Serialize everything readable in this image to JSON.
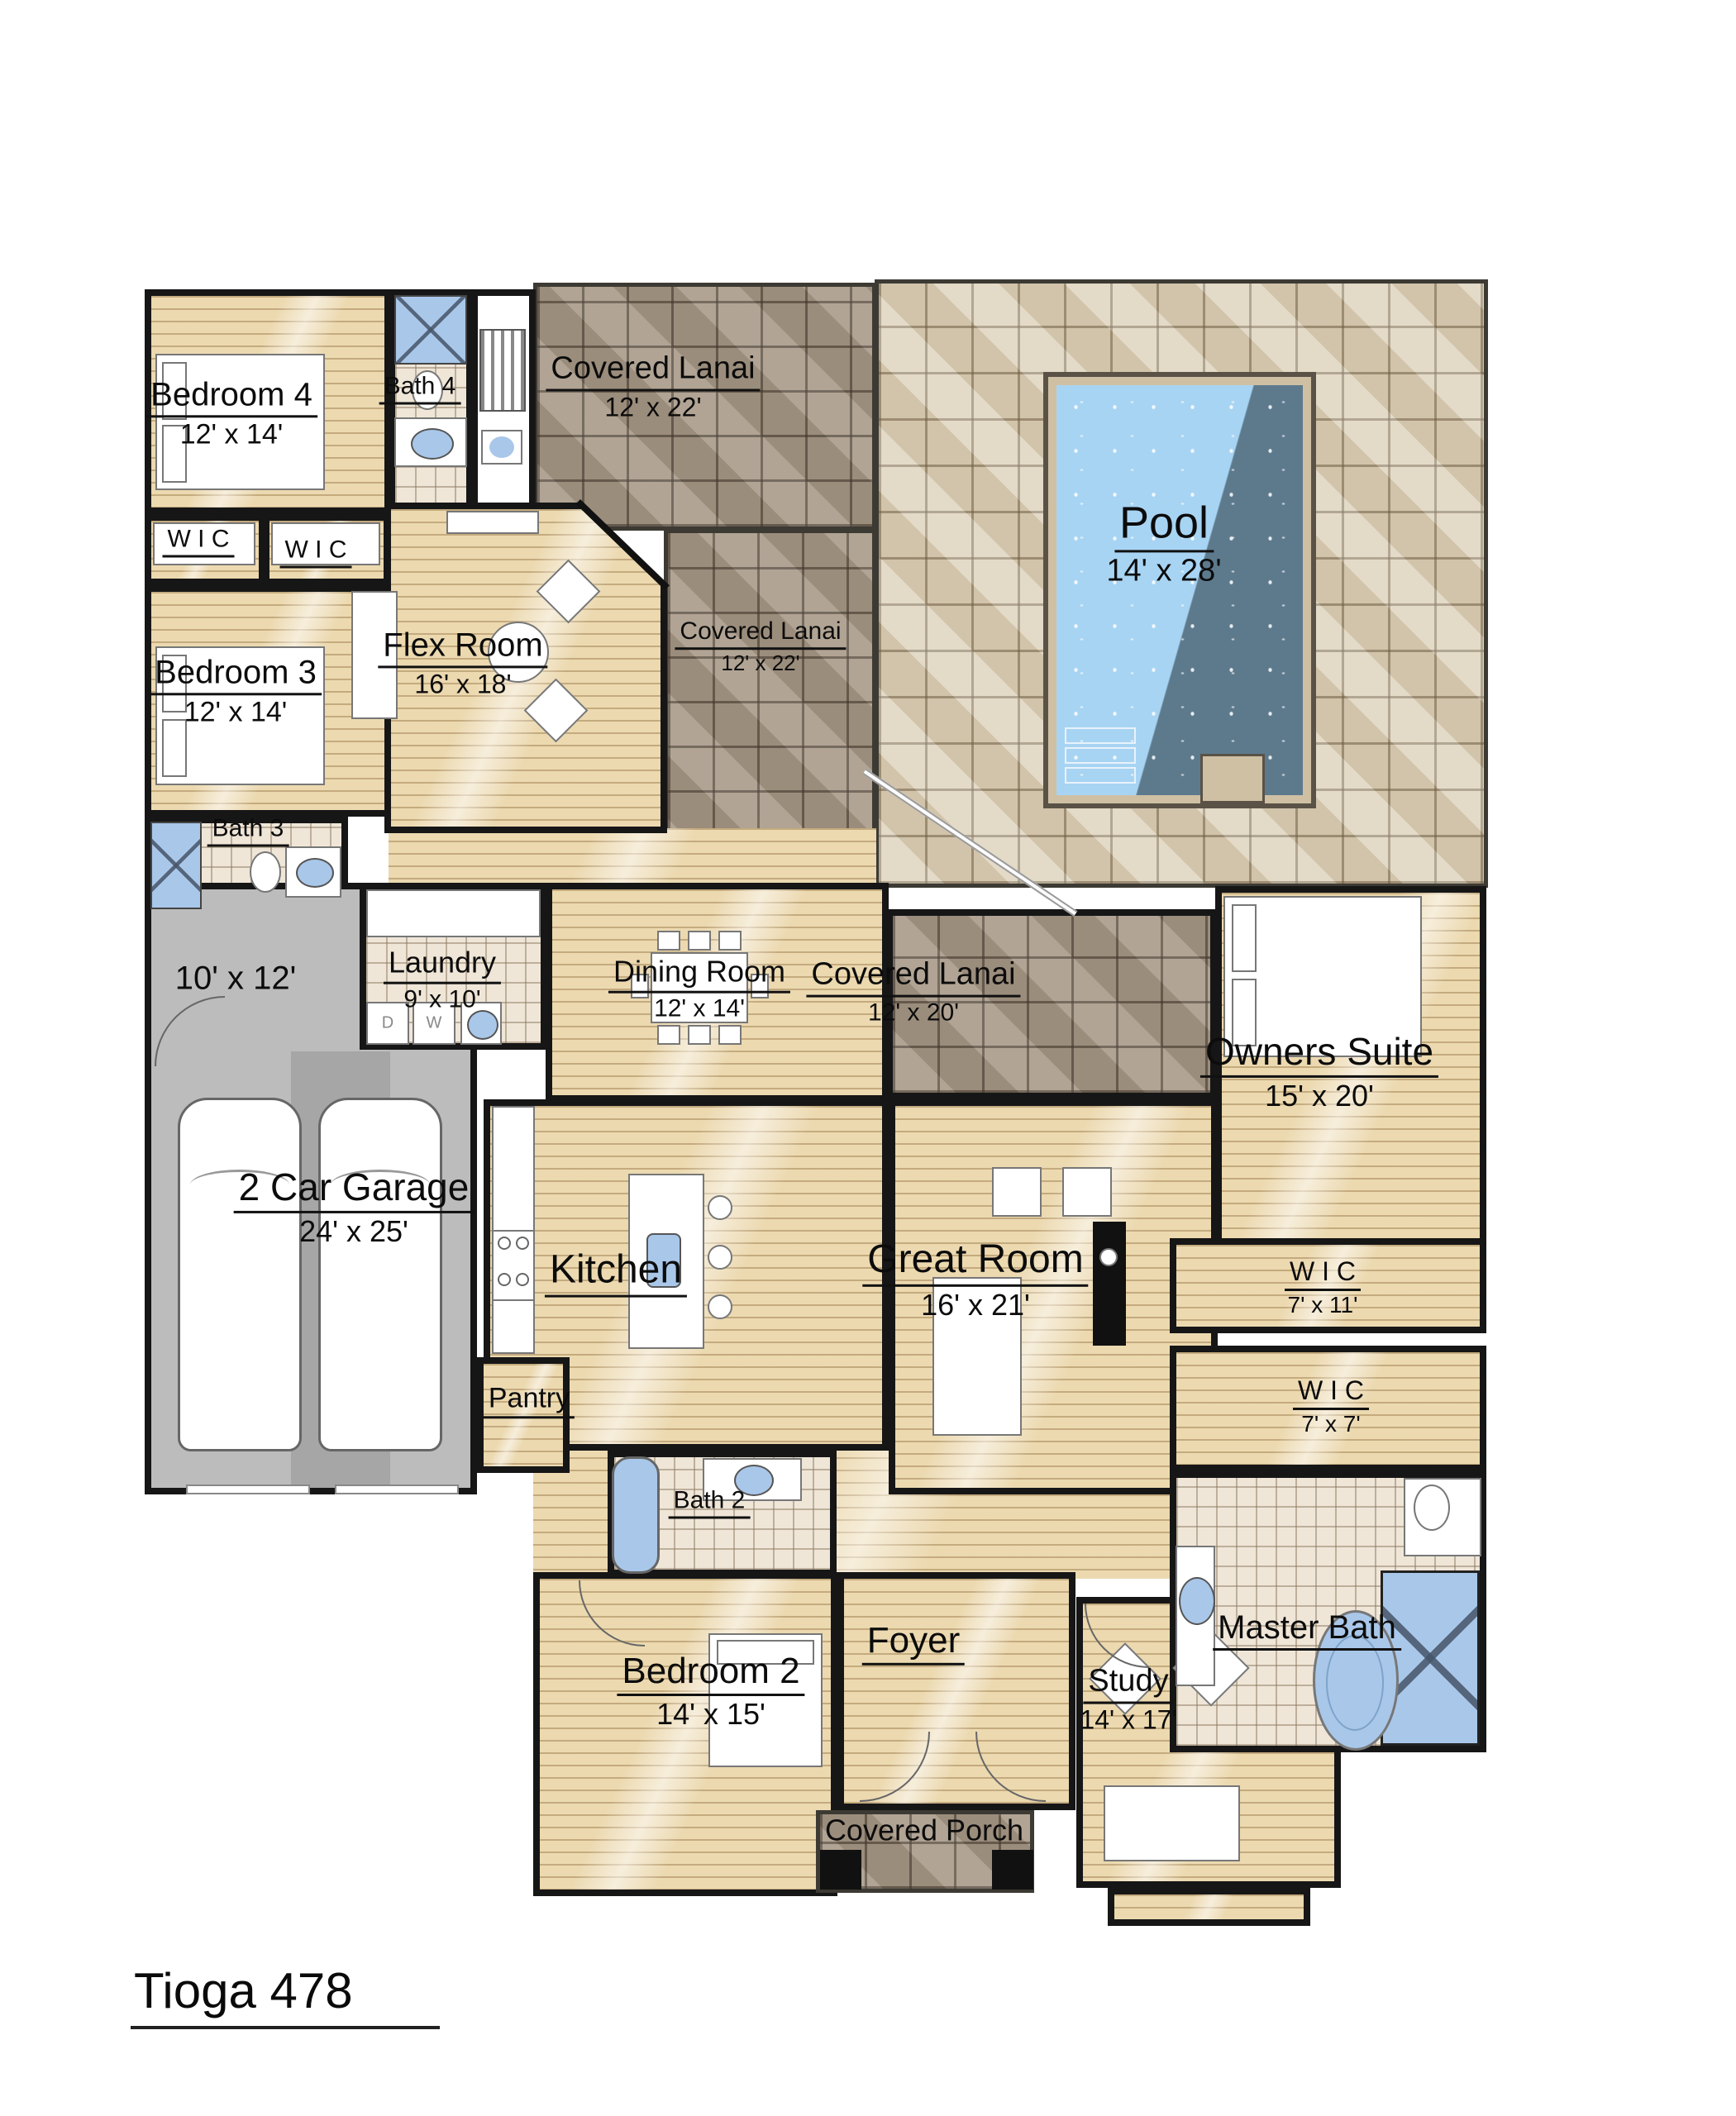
{
  "title": "Tioga 478",
  "rooms": {
    "bedroom4": {
      "name": "Bedroom 4",
      "dims": "12' x 14'"
    },
    "bath4": {
      "name": "Bath 4"
    },
    "lanai_top": {
      "name": "Covered Lanai",
      "dims": "12' x 22'"
    },
    "lanai_mid": {
      "name": "Covered Lanai",
      "dims": "12' x 22'"
    },
    "lanai_right": {
      "name": "Covered Lanai",
      "dims": "12' x 20'"
    },
    "pool": {
      "name": "Pool",
      "dims": "14' x 28'"
    },
    "wic_a": {
      "name": "W I C"
    },
    "wic_b": {
      "name": "W I C"
    },
    "wic_c": {
      "name": "W I C",
      "dims": "7' x 11'"
    },
    "wic_d": {
      "name": "W I C",
      "dims": "7' x 7'"
    },
    "bedroom3": {
      "name": "Bedroom 3",
      "dims": "12' x 14'"
    },
    "flex": {
      "name": "Flex Room",
      "dims": "16' x 18'"
    },
    "bath3": {
      "name": "Bath 3"
    },
    "garage_bay": {
      "dims": "10' x 12'"
    },
    "laundry": {
      "name": "Laundry",
      "dims": "9' x 10'"
    },
    "dining": {
      "name": "Dining Room",
      "dims": "12' x 14'"
    },
    "owners": {
      "name": "Owners Suite",
      "dims": "15' x 20'"
    },
    "garage": {
      "name": "2 Car Garage",
      "dims": "24' x 25'"
    },
    "kitchen": {
      "name": "Kitchen"
    },
    "great": {
      "name": "Great Room",
      "dims": "16' x 21'"
    },
    "pantry": {
      "name": "Pantry"
    },
    "bath2": {
      "name": "Bath 2"
    },
    "foyer": {
      "name": "Foyer"
    },
    "bedroom2": {
      "name": "Bedroom 2",
      "dims": "14' x 15'"
    },
    "study": {
      "name": "Study",
      "dims": "14' x 17'"
    },
    "masterbath": {
      "name": "Master Bath"
    },
    "porch": {
      "name": "Covered Porch"
    }
  },
  "appliances": {
    "dryer": "D",
    "washer": "W"
  },
  "colors": {
    "wood_floor": "#ecd9b0",
    "lanai_tile": "#a89a88",
    "deck_tile": "#dbcfb7",
    "pool_water": "#a8d4f3",
    "pool_shadow": "#5d7a8d",
    "garage_floor": "#bcbcbc",
    "fixture_blue": "#a9c7e9",
    "wall": "#161616"
  }
}
